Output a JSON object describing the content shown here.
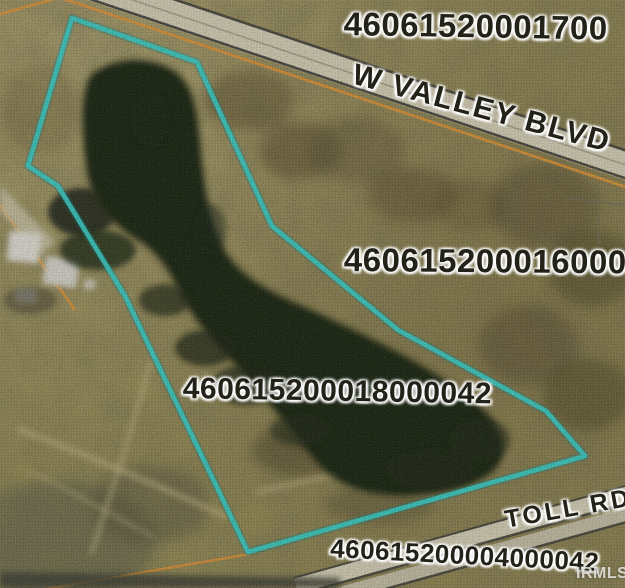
{
  "map": {
    "parcel_labels": {
      "north": "46061520001700",
      "east": "4606152000160000",
      "subject": "460615200018000042",
      "south": "460615200004000042"
    },
    "street_labels": {
      "north": "W VALLEY BLVD",
      "south": "TOLL RD"
    },
    "watermark": "IRMLS",
    "colors": {
      "boundary_highlight": "#31c7c0",
      "boundary_glow": "#157f7d",
      "parcel_line_orange": "#d98e2f",
      "road_surface": "#cdc7ae",
      "road_edge": "#45453a",
      "pond_water": "#15200f",
      "terrain": "#8f854f"
    }
  }
}
